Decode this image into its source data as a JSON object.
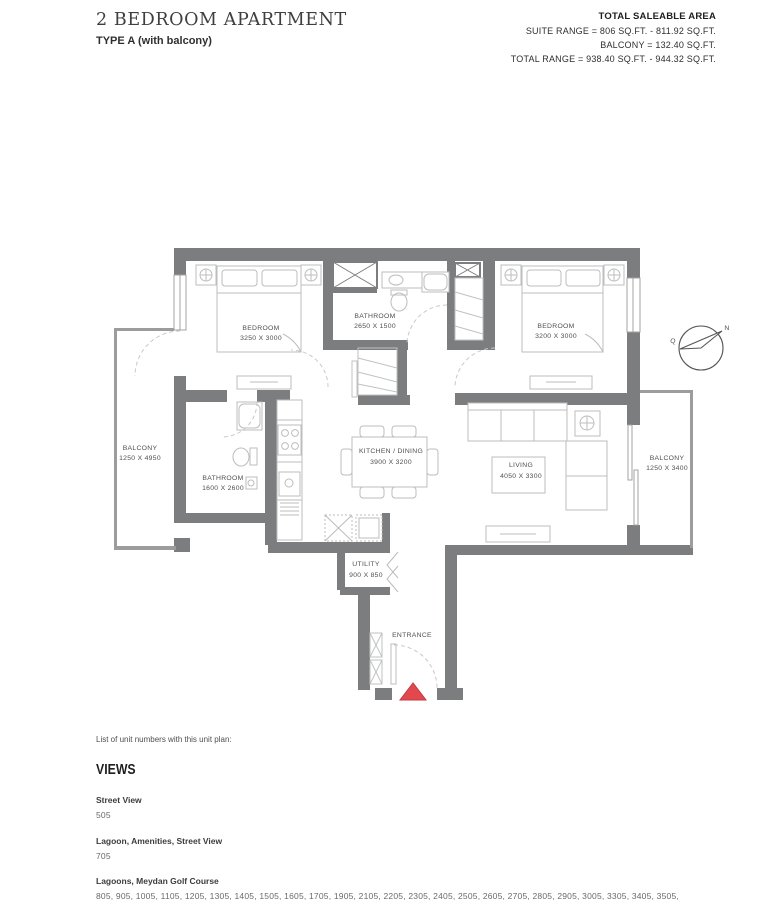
{
  "header": {
    "title": "2 BEDROOM APARTMENT",
    "subtitle": "TYPE A (with balcony)",
    "saleable": {
      "heading": "TOTAL SALEABLE AREA",
      "suite_range": "SUITE RANGE = 806 SQ.FT. - 811.92 SQ.FT.",
      "balcony": "BALCONY = 132.40 SQ.FT.",
      "total_range": "TOTAL RANGE =  938.40 SQ.FT. - 944.32 SQ.FT."
    }
  },
  "plan": {
    "rooms": {
      "bedroom_left": {
        "name": "BEDROOM",
        "dims": "3250 X 3000"
      },
      "bathroom_top": {
        "name": "BATHROOM",
        "dims": "2650 X 1500"
      },
      "bedroom_right": {
        "name": "BEDROOM",
        "dims": "3200 X 3000"
      },
      "balcony_left": {
        "name": "BALCONY",
        "dims": "1250 X 4950"
      },
      "bathroom_left": {
        "name": "BATHROOM",
        "dims": "1600 X 2600"
      },
      "kitchen_dining": {
        "name": "KITCHEN / DINING",
        "dims": "3900 X 3200"
      },
      "living": {
        "name": "LIVING",
        "dims": "4050 X 3300"
      },
      "balcony_right": {
        "name": "BALCONY",
        "dims": "1250 X 3400"
      },
      "utility": {
        "name": "UTILITY",
        "dims": "900 X 850"
      }
    },
    "entrance_label": "ENTRANCE",
    "compass": {
      "north": "N",
      "mark": "Q"
    }
  },
  "footer": {
    "intro": "List of unit numbers with this unit plan:",
    "views_title": "VIEWS",
    "views": [
      {
        "view": "Street View",
        "units": "505"
      },
      {
        "view": "Lagoon, Amenities, Street View",
        "units": "705"
      },
      {
        "view": "Lagoons, Meydan Golf Course",
        "units": "805, 905, 1005, 1105, 1205, 1305, 1405, 1505, 1605, 1705, 1905, 2105, 2205, 2305, 2405, 2505, 2605, 2705, 2805, 2905, 3005, 3305, 3405, 3505, 3605, 3705, 3805, 3905, 4005, 4105, 4205, 4405, 4605, 4705, 4805, 4905, 5005, 5105, 5205, 5305, 5405, 5505"
      }
    ]
  },
  "colors": {
    "wall": "#7c7d7f",
    "balcony_wall": "#9b9c9e",
    "entrance_marker": "#e2484d"
  }
}
